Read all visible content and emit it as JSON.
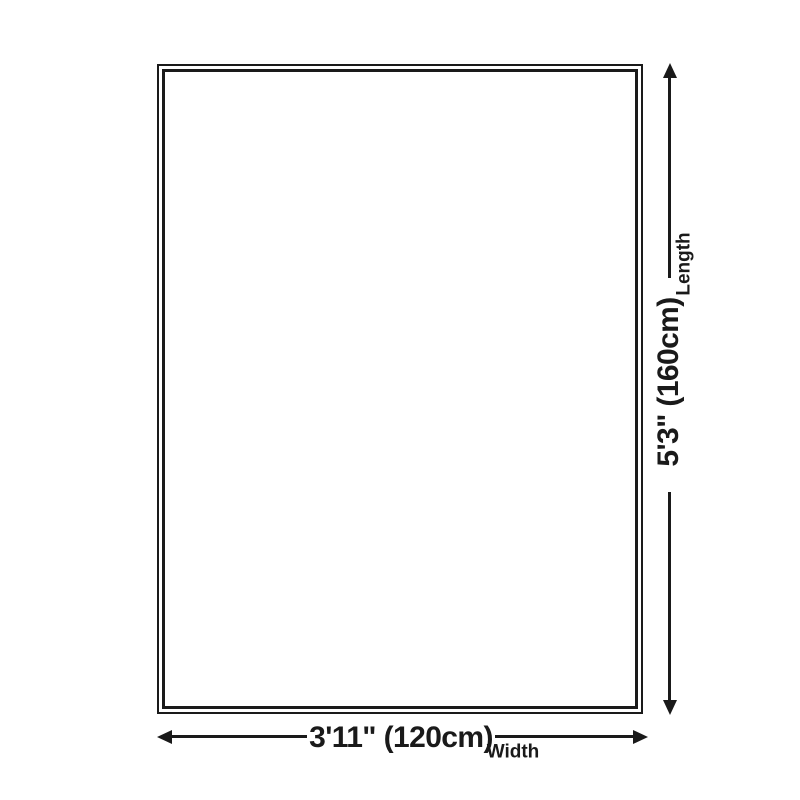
{
  "diagram": {
    "kind": "product-size-diagram",
    "dimensions": {
      "length": {
        "label": "Length",
        "value": "5'3\" (160cm)"
      },
      "width": {
        "label": "Width",
        "value": "3'11\" (120cm)"
      }
    },
    "colors": {
      "line": "#1a1a1a",
      "background": "#ffffff"
    }
  }
}
